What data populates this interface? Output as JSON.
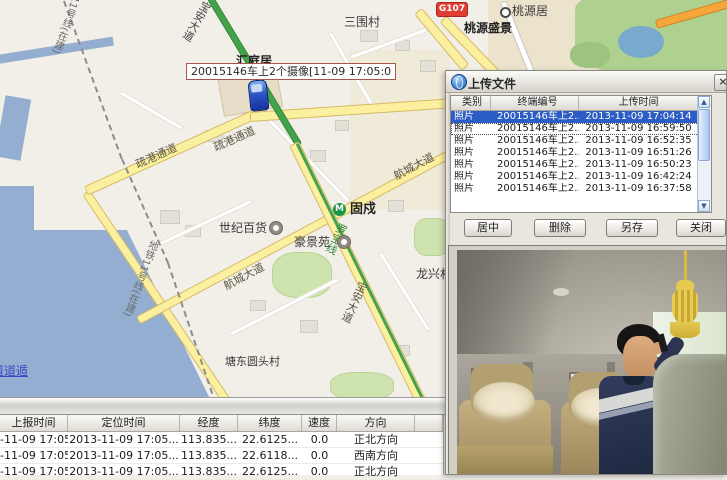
{
  "colors": {
    "selection": "#2c5cc5",
    "road_yellow": "#fbf0a0",
    "road_green": "#44a24c",
    "water": "#93aed0",
    "tooltip_border": "#a8564a",
    "g107_red": "#e03c34"
  },
  "map": {
    "vehicle_tooltip": "20015146车上2个摄像[11-09 17:05:0",
    "roads": {
      "shugang": "疏港通道",
      "shugang2": "疏港通道",
      "hangcheng": "航城大道",
      "hangcheng2": "航城大道",
      "baoan_top": "宝安大道",
      "baoan_mid": "宝安大道",
      "luobao": "罗宝线",
      "g107": "G107",
      "metro11_top": "11号线(在建)",
      "metro11_mid": "地铁11号线(在建)"
    },
    "places": {
      "sanweicun": "三围村",
      "huitingju": "汇庭居",
      "taoyuanju": "桃源居",
      "taoyuan_shengjing": "桃源盛景",
      "shiji_baihuo": "世纪百货",
      "haojingyuan": "豪景苑",
      "gushu": "固戍",
      "gushu_metro_logo": "M",
      "longxingcun": "龙兴村",
      "tangdong": "塘东圆头村",
      "watermark": "道道遁"
    }
  },
  "dialog": {
    "title": "上传文件",
    "close_glyph": "×",
    "scroll_up_glyph": "▲",
    "scroll_down_glyph": "▼",
    "table": {
      "columns": [
        "类别",
        "终端编号",
        "上传时间"
      ],
      "rows": [
        {
          "type": "照片",
          "terminal": "20015146车上2...",
          "time": "2013-11-09 17:04:14",
          "selected": true
        },
        {
          "type": "照片",
          "terminal": "20015146车上2...",
          "time": "2013-11-09 16:59:50",
          "focused": true
        },
        {
          "type": "照片",
          "terminal": "20015146车上2...",
          "time": "2013-11-09 16:52:35"
        },
        {
          "type": "照片",
          "terminal": "20015146车上2...",
          "time": "2013-11-09 16:51:26"
        },
        {
          "type": "照片",
          "terminal": "20015146车上2...",
          "time": "2013-11-09 16:50:23"
        },
        {
          "type": "照片",
          "terminal": "20015146车上2...",
          "time": "2013-11-09 16:42:24"
        },
        {
          "type": "照片",
          "terminal": "20015146车上2...",
          "time": "2013-11-09 16:37:58"
        }
      ]
    },
    "buttons": {
      "center": "居中",
      "delete": "删除",
      "save_as": "另存",
      "close": "关闭"
    }
  },
  "track_table": {
    "columns": [
      "上报时间",
      "定位时间",
      "经度",
      "纬度",
      "速度",
      "方向"
    ],
    "rows": [
      [
        "-11-09 17:05...",
        "2013-11-09 17:05...",
        "113.835...",
        "22.6125...",
        "0.0",
        "正北方向"
      ],
      [
        "-11-09 17:05...",
        "2013-11-09 17:05...",
        "113.835...",
        "22.6118...",
        "0.0",
        "西南方向"
      ],
      [
        "-11-09 17:05",
        "2013-11-09 17:05...",
        "113.835...",
        "22.6125...",
        "0.0",
        "正北方向"
      ]
    ]
  }
}
